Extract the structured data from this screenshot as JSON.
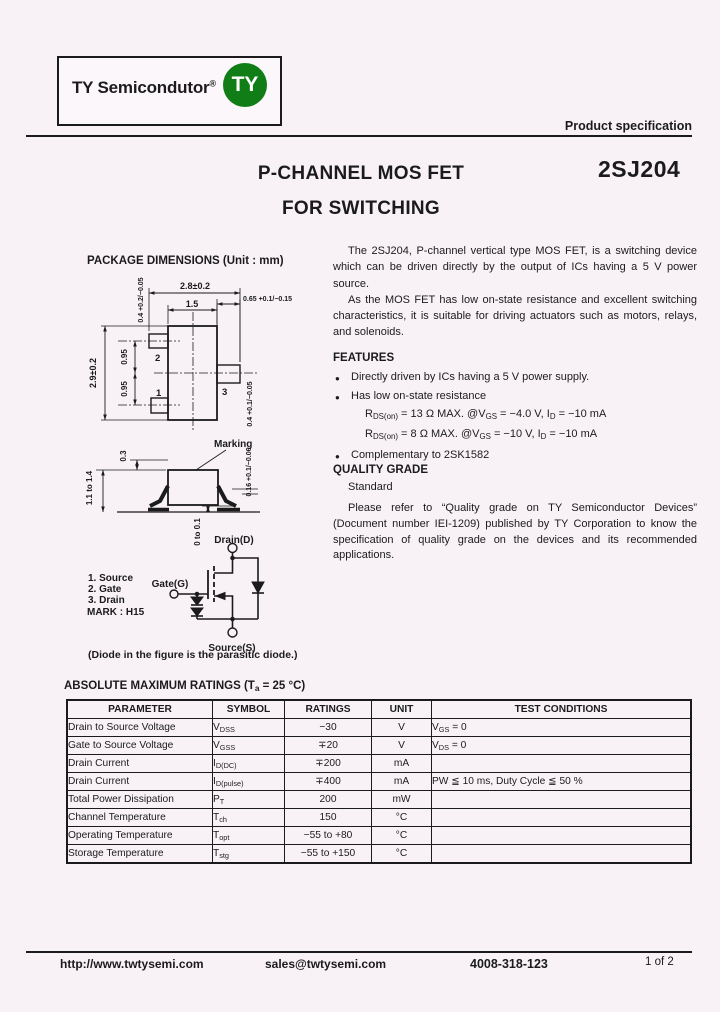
{
  "header": {
    "brand": "TY Semicondutor",
    "reg_mark": "®",
    "badge_text": "TY",
    "badge_color": "#117d17",
    "spec_label": "Product specification"
  },
  "title": {
    "line1": "P-CHANNEL MOS FET",
    "line2": "FOR SWITCHING",
    "part": "2SJ204"
  },
  "package": {
    "heading": "PACKAGE DIMENSIONS (Unit : mm)",
    "top": {
      "dim_overall": "2.8±0.2",
      "dim_body": "1.5",
      "dim_lead3": "0.65 +0.1/−0.15",
      "dim_height": "2.9±0.2",
      "dim_pitch1": "0.95",
      "dim_pitch2": "0.95",
      "dim_lead_left": "0.4 +0.2/−0.05",
      "dim_lead_right": "0.4 +0.1/−0.05",
      "pin1": "1",
      "pin2": "2",
      "pin3": "3"
    },
    "side": {
      "marking": "Marking",
      "dim_mark": "0.3",
      "dim_height": "1.1 to 1.4",
      "dim_standoff": "0 to 0.1",
      "dim_lead_thickness": "0.16 +0.1/−0.06"
    }
  },
  "circuit": {
    "drain": "Drain(D)",
    "gate": "Gate(G)",
    "source": "Source(S)",
    "pin_list": [
      "1. Source",
      "2. Gate",
      "3. Drain"
    ],
    "mark": "MARK : H15",
    "caption": "(Diode in the figure is the parasitic diode.)"
  },
  "intro": {
    "p1": "The 2SJ204, P-channel vertical type MOS FET, is a switching device which can be driven directly by the output of ICs having a 5 V power source.",
    "p2": "As the MOS FET has low on-state resistance and excellent switching characteristics, it is suitable for driving actuators such as motors, relays, and solenoids."
  },
  "features": {
    "heading": "FEATURES",
    "bullet_glyph": "●",
    "b1": "Directly driven by ICs having a 5 V power supply.",
    "b2": "Has low on-state resistance",
    "rds1": "R~DS(on)~ = 13 Ω MAX. @V~GS~ = −4.0 V, I~D~ = −10 mA",
    "rds2": "R~DS(on)~ = 8 Ω MAX. @V~GS~ = −10 V, I~D~ = −10 mA",
    "b3": "Complementary to 2SK1582"
  },
  "quality": {
    "heading": "QUALITY GRADE",
    "grade": "Standard",
    "note": "Please refer to “Quality grade on TY Semiconductor Devices” (Document number IEI-1209) published by TY Corporation to know the specification of quality grade on the devices and its recommended applications."
  },
  "ratings": {
    "heading": "ABSOLUTE MAXIMUM RATINGS (T~a~ = 25 °C)",
    "columns": [
      "PARAMETER",
      "SYMBOL",
      "RATINGS",
      "UNIT",
      "TEST CONDITIONS"
    ],
    "rows": [
      {
        "param": "Drain to Source Voltage",
        "symbol": "V~DSS~",
        "rating": "−30",
        "unit": "V",
        "cond": "V~GS~ = 0"
      },
      {
        "param": "Gate to Source Voltage",
        "symbol": "V~GSS~",
        "rating": "∓20",
        "unit": "V",
        "cond": "V~DS~ = 0"
      },
      {
        "param": "Drain Current",
        "symbol": "I~D(DC)~",
        "rating": "∓200",
        "unit": "mA",
        "cond": ""
      },
      {
        "param": "Drain Current",
        "symbol": "I~D(pulse)~",
        "rating": "∓400",
        "unit": "mA",
        "cond": "PW ≦ 10 ms, Duty Cycle ≦ 50 %"
      },
      {
        "param": "Total Power Dissipation",
        "symbol": "P~T~",
        "rating": "200",
        "unit": "mW",
        "cond": ""
      },
      {
        "param": "Channel Temperature",
        "symbol": "T~ch~",
        "rating": "150",
        "unit": "°C",
        "cond": ""
      },
      {
        "param": "Operating Temperature",
        "symbol": "T~opt~",
        "rating": "−55 to +80",
        "unit": "°C",
        "cond": ""
      },
      {
        "param": "Storage Temperature",
        "symbol": "T~stg~",
        "rating": "−55 to +150",
        "unit": "°C",
        "cond": ""
      }
    ]
  },
  "footer": {
    "url": "http://www.twtysemi.com",
    "email": "sales@twtysemi.com",
    "phone": "4008-318-123",
    "page": "1 of 2"
  }
}
